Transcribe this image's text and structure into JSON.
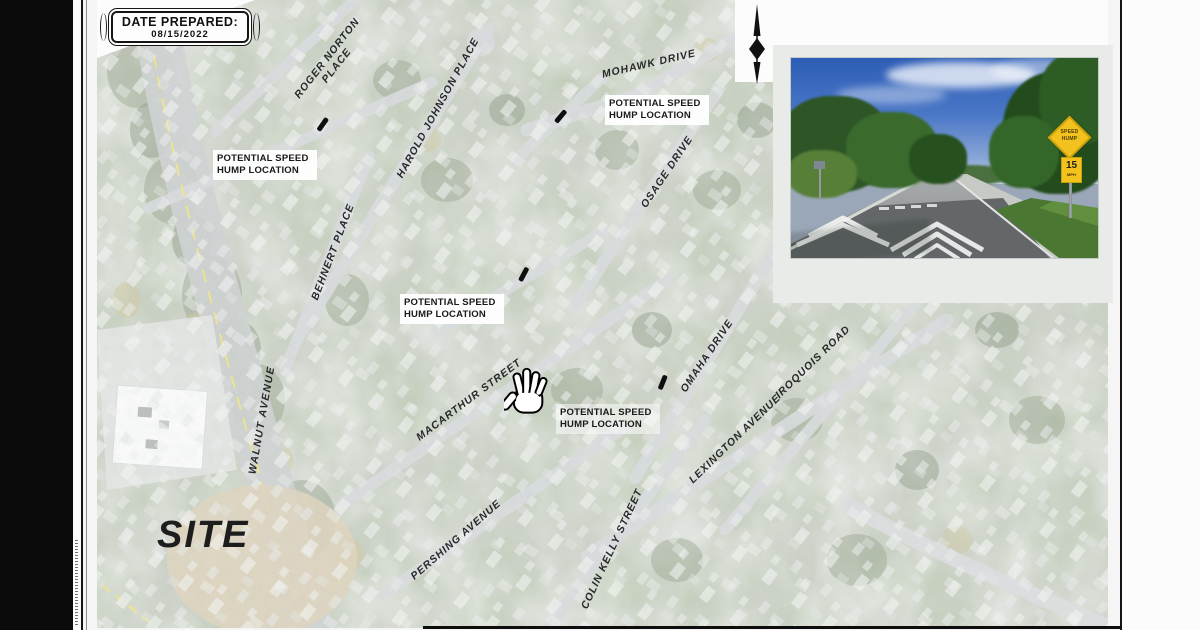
{
  "sheet": {
    "date_box": {
      "label": "DATE PREPARED:",
      "value": "08/15/2022"
    },
    "site_label": "SITE",
    "icons": {
      "north_arrow": "north-arrow-needle",
      "hand_cursor": "open-hand-pan-cursor"
    }
  },
  "map": {
    "speed_hump_label": "POTENTIAL SPEED HUMP LOCATION",
    "streets": [
      "ROGER NORTON PLACE",
      "HAROLD JOHNSON PLACE",
      "BEHNERT PLACE",
      "MOHAWK DRIVE",
      "OSAGE DRIVE",
      "OMAHA DRIVE",
      "IROQUOIS ROAD",
      "WALNUT AVENUE",
      "MACARTHUR STREET",
      "LEXINGTON AVENUE",
      "PERSHING AVENUE",
      "COLIN KELLY STREET"
    ]
  },
  "inset_photo": {
    "speed_hump_sign": {
      "top_line": "SPEED",
      "bottom_line": "HUMP",
      "speed": "15",
      "unit": "MPH"
    }
  },
  "colors": {
    "road_centerline_yellow": "#e8d84f",
    "sign_yellow": "#f3c21e",
    "map_wash_overlay": "#ffffff",
    "page_border_black": "#141414"
  }
}
